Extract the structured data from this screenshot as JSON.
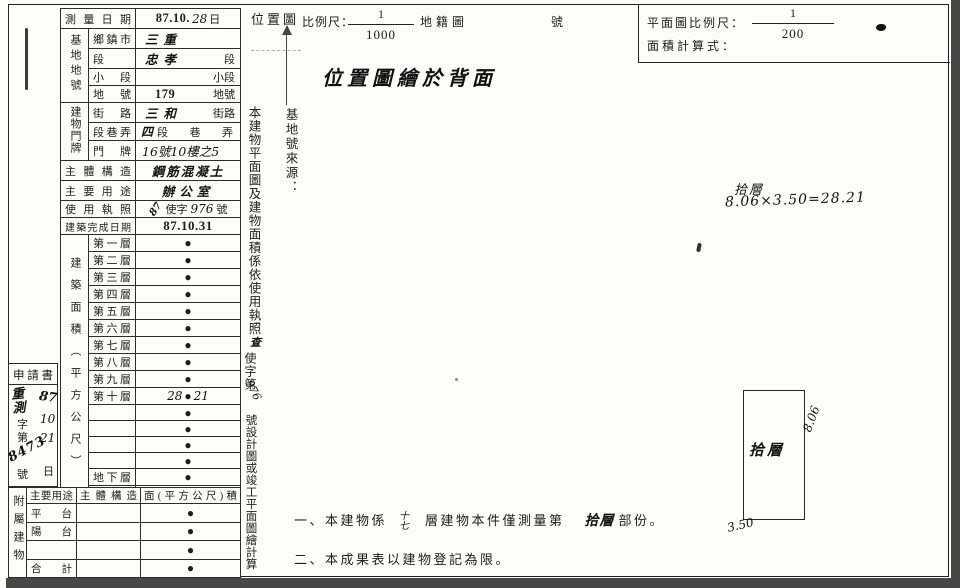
{
  "header": {
    "location_map_label": "位置圖",
    "scale_label": "比例尺：",
    "scale_numerator": "1",
    "scale_denominator": "1000",
    "cadastral_map_label": "地籍圖",
    "number_label": "號",
    "plan_scale_label": "平面圖比例尺：",
    "plan_scale_numerator": "1",
    "plan_scale_denominator": "200",
    "area_formula_label": "面積計算式：",
    "location_note": "位置圖繪於背面"
  },
  "main_table": {
    "survey_date_label": "測量日期",
    "survey_date_stamp": "87.10.",
    "survey_date_hw": "28",
    "survey_date_suffix": "日",
    "land_group_label": "基地地號",
    "land_rows": [
      {
        "label": "鄉鎮市",
        "hw": "三重",
        "suffix": ""
      },
      {
        "label": "段",
        "hw": "忠孝",
        "suffix": "段"
      },
      {
        "label": "小段",
        "hw": "",
        "suffix": "小段"
      },
      {
        "label": "地號",
        "hw": "179",
        "suffix": "地號"
      }
    ],
    "address_group_label": "建物門牌",
    "address_rows": [
      {
        "label": "街路",
        "hw": "三和",
        "suffix": "街路"
      },
      {
        "label": "段巷弄",
        "hw": "四",
        "suffix": "段巷弄"
      },
      {
        "label": "門牌",
        "hw": "16號10樓之5",
        "suffix": ""
      }
    ],
    "structure_label": "主體構造",
    "structure_value": "鋼筋混凝土",
    "usage_label": "主要用途",
    "usage_value": "辦公室",
    "license_label": "使用執照",
    "license_year_hw": "87",
    "license_prefix": "使字",
    "license_number_hw": "976",
    "license_suffix": "號",
    "completion_label": "建築完成日期",
    "completion_value": "87.10.31",
    "area_group_label": "建築面積（平方公尺）",
    "area_dot": "●",
    "floor_rows": [
      {
        "label": "第一層",
        "pre": "",
        "post": ""
      },
      {
        "label": "第二層",
        "pre": "",
        "post": ""
      },
      {
        "label": "第三層",
        "pre": "",
        "post": ""
      },
      {
        "label": "第四層",
        "pre": "",
        "post": ""
      },
      {
        "label": "第五層",
        "pre": "",
        "post": ""
      },
      {
        "label": "第六層",
        "pre": "",
        "post": ""
      },
      {
        "label": "第七層",
        "pre": "",
        "post": ""
      },
      {
        "label": "第八層",
        "pre": "",
        "post": ""
      },
      {
        "label": "第九層",
        "pre": "",
        "post": ""
      },
      {
        "label": "第十層",
        "pre": "28",
        "post": "21"
      },
      {
        "label": "",
        "pre": "",
        "post": ""
      },
      {
        "label": "",
        "pre": "",
        "post": ""
      },
      {
        "label": "",
        "pre": "",
        "post": ""
      },
      {
        "label": "",
        "pre": "",
        "post": ""
      },
      {
        "label": "地下層",
        "pre": "",
        "post": ""
      },
      {
        "label": "騎樓",
        "pre": "",
        "post": ""
      }
    ],
    "total_label": "合計",
    "total_pre": "28",
    "total_post": "21"
  },
  "applicant": {
    "title": "申請書",
    "stamp": "重測",
    "prefix": "字第",
    "number": "8473",
    "number_suffix": "號",
    "date_year": "87",
    "date_month": "10",
    "date_day": "21",
    "date_suffix": "日"
  },
  "annex_table": {
    "group_label": "附屬建物",
    "headers": {
      "use": "主要用途",
      "structure": "主體構造",
      "area": "面(平方公尺)積"
    },
    "dot": "●",
    "rows": [
      {
        "use": "平台"
      },
      {
        "use": "陽台"
      },
      {
        "use": ""
      },
      {
        "use": "合計"
      }
    ]
  },
  "source_note": {
    "heading": "基地號來源：",
    "body": "本建物平面圖及建物面積係依使用執照",
    "check_hw": "查",
    "license_prefix": "使字第",
    "license_number_hw": "976",
    "body2": "號設計圖或竣工平面圖繪計算"
  },
  "calc_note": {
    "floor": "拾層",
    "formula": "8.06×3.50=28.21"
  },
  "floor_plan": {
    "label": "拾層",
    "dim_right": "8.06",
    "dim_bottom": "3.50"
  },
  "footnotes": {
    "n1_pre": "一、本建物係",
    "n1_floors_top": "十",
    "n1_floors_bottom": "七",
    "n1_mid": "層建物本件僅測量第",
    "n1_part": "拾層",
    "n1_post": "部份。",
    "n2": "二、本成果表以建物登記為限。"
  }
}
